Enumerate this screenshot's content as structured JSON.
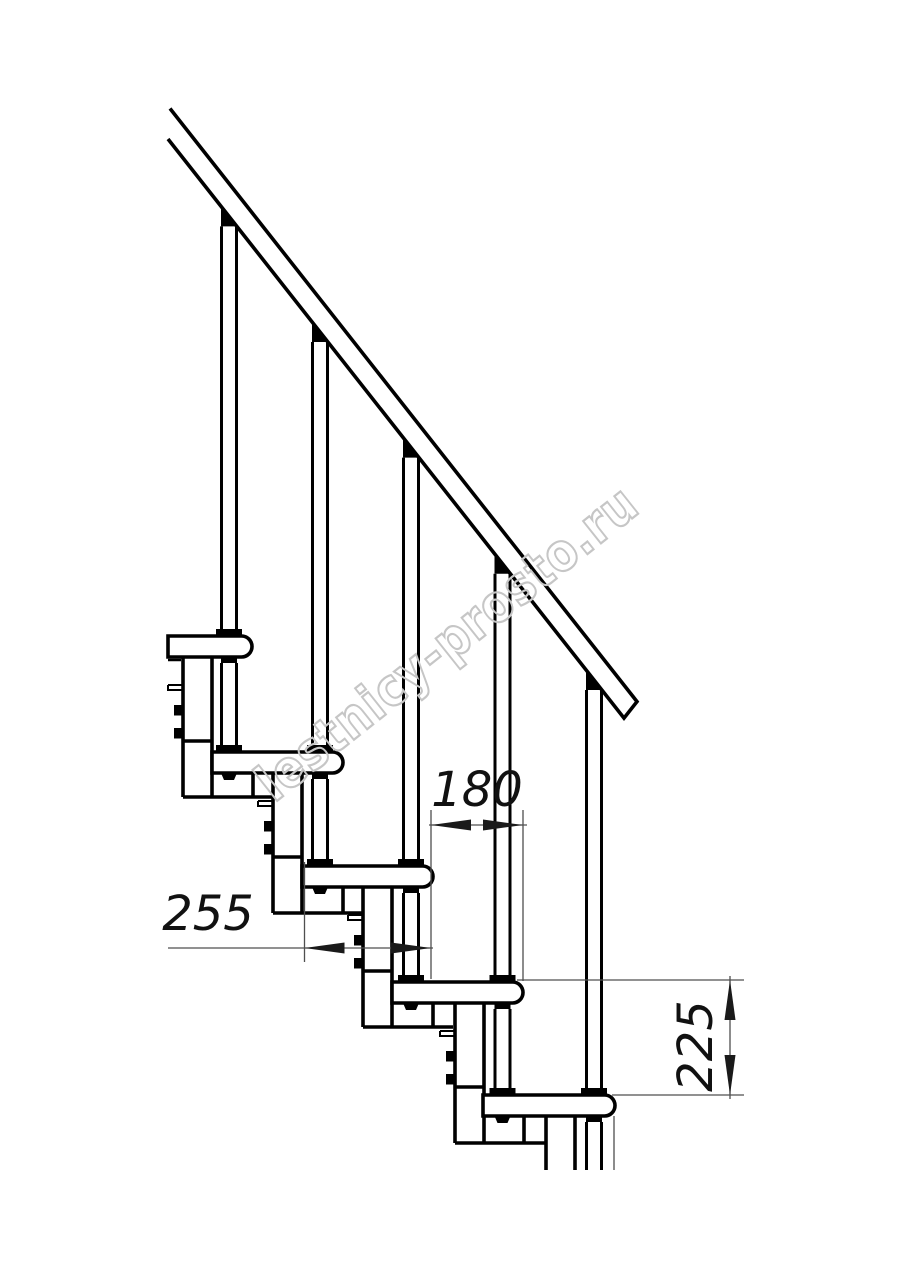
{
  "watermark": {
    "text": "lestnicy-prosto.ru",
    "color": "#c6c6c6"
  },
  "dimensions": {
    "tread_depth": {
      "label": "255",
      "value": 255,
      "orientation": "horizontal"
    },
    "going": {
      "label": "180",
      "value": 180,
      "orientation": "horizontal"
    },
    "rise": {
      "label": "225",
      "value": 225,
      "orientation": "vertical"
    }
  },
  "drawing": {
    "type": "modular staircase side elevation",
    "treads_visible": 5,
    "balusters_visible": 5,
    "line_color": "#000000",
    "dimension_line_color": "#4f4f4f",
    "dimension_text_color": "#111111",
    "background": "#ffffff"
  }
}
